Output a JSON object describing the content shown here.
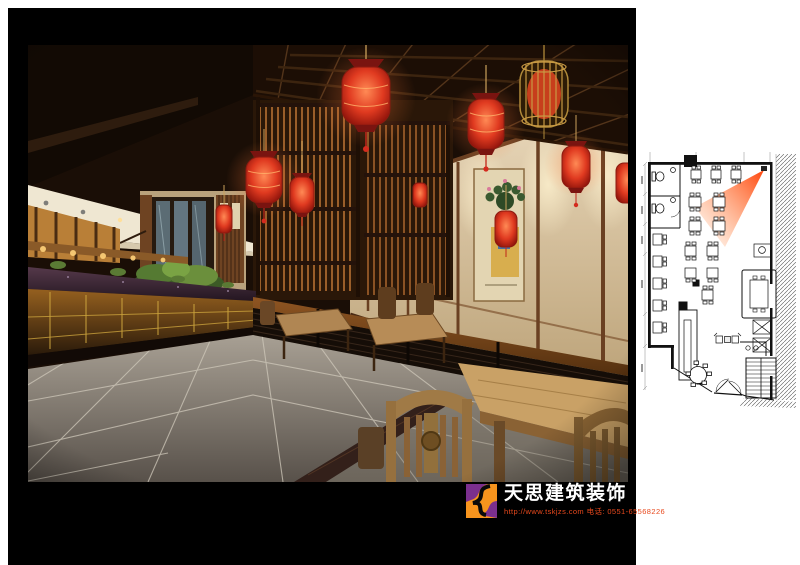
{
  "meta": {
    "page_background": "#ffffff",
    "frame_color": "#000000"
  },
  "logo": {
    "title": "天思建筑装饰",
    "contact": "http://www.tskjzs.com 电话: 0551-65568226",
    "title_color": "#ffffff",
    "contact_color": "#e8491d",
    "mark_colors": {
      "purple": "#7b2f8e",
      "orange": "#f7941d",
      "swirl": "#0a0a0a"
    }
  },
  "rendering": {
    "palette": {
      "lantern_red": "#d93a26",
      "gold_cage": "#c89a44",
      "wood_brown": "#8a5526",
      "ceiling_cream": "#efe7d2",
      "wall_cream": "#e3d5b2",
      "floor_gray": "#9a9288",
      "marble_counter": "#3f2b38",
      "glass_amber": "#7a4e1e"
    },
    "elements": [
      "red-lanterns",
      "gold-cage-lantern",
      "wood-slat-screens",
      "lattice-ceiling",
      "spotlight-band",
      "buffet-counter",
      "opera-scroll-painting",
      "dining-tables",
      "carved-chairs",
      "stone-tile-floor",
      "entrance-vestibule",
      "plants",
      "low-partition-wall"
    ]
  },
  "floorplan": {
    "view_cone_color": "#ff5200",
    "elements": [
      "wc-rooms",
      "toilets",
      "dining-tables",
      "round-table",
      "sofa-set",
      "service-counter",
      "private-room",
      "wall-cabinets",
      "reception-desk",
      "stairs",
      "entrance-doors",
      "camera-view-cone",
      "wall-hatching",
      "dimension-lines"
    ]
  }
}
